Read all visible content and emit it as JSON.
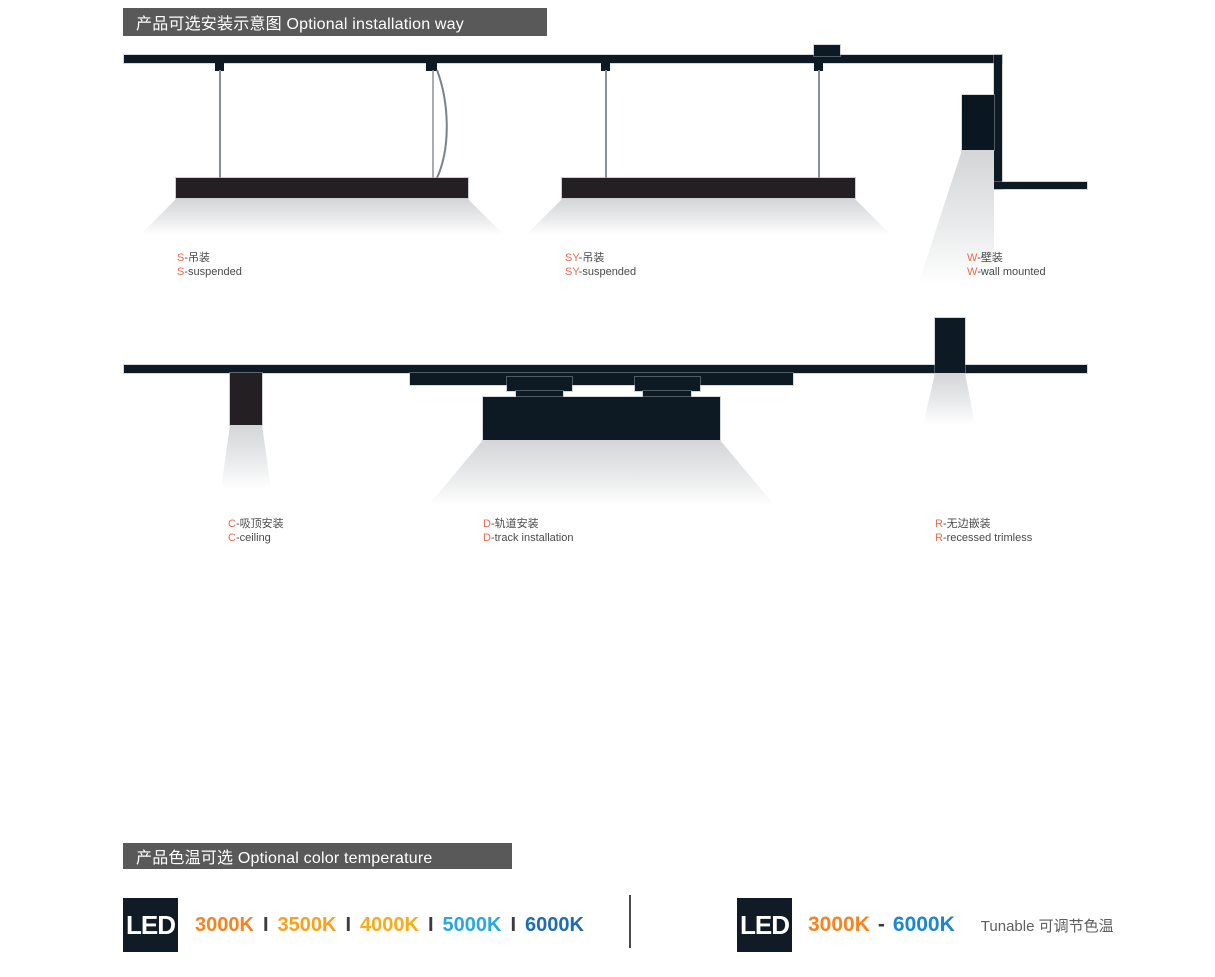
{
  "installation": {
    "header": "产品可选安装示意图 Optional installation way",
    "accent_color": "#e96a4c",
    "labels": {
      "s": {
        "prefix": "S",
        "zh": "-吊装",
        "en": "-suspended"
      },
      "sy": {
        "prefix": "SY",
        "zh": "-吊装",
        "en": "-suspended"
      },
      "w": {
        "prefix": "W",
        "zh": "-壁装",
        "en": "-wall mounted"
      },
      "c": {
        "prefix": "C",
        "zh": "-吸顶安装",
        "en": "-ceiling"
      },
      "d": {
        "prefix": "D",
        "zh": "-轨道安装",
        "en": "-track installation"
      },
      "r": {
        "prefix": "R",
        "zh": "-无边嵌装",
        "en": "-recessed trimless"
      }
    }
  },
  "color_temperature": {
    "header": "产品色温可选 Optional color temperature",
    "led_badge": "LED",
    "separator": "I",
    "fixed_options": [
      {
        "label": "3000K",
        "color": "#f5831f"
      },
      {
        "label": "3500K",
        "color": "#f9a11c"
      },
      {
        "label": "4000K",
        "color": "#fbaa1a"
      },
      {
        "label": "5000K",
        "color": "#2aa7e0"
      },
      {
        "label": "6000K",
        "color": "#1d6cb5"
      }
    ],
    "tunable": {
      "from": "3000K",
      "from_color": "#f5831f",
      "dash": "-",
      "to": "6000K",
      "to_color": "#1c86d2",
      "note": "Tunable 可调节色温"
    }
  }
}
